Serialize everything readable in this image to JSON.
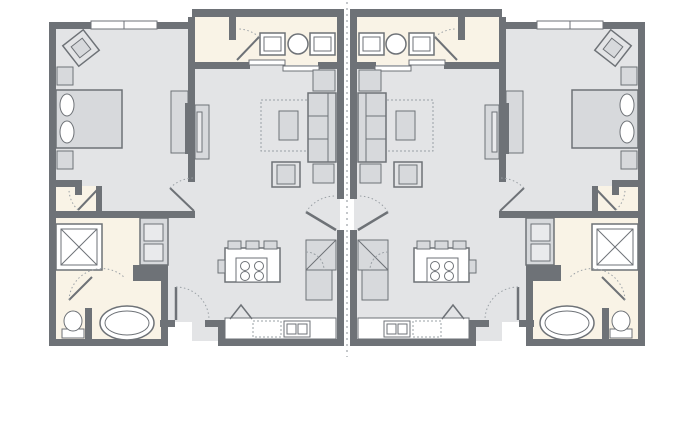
{
  "canvas": {
    "width": 697,
    "height": 445,
    "background": "#ffffff"
  },
  "palette": {
    "wall": "#6e7277",
    "floor_gray": "#e3e4e6",
    "floor_cream": "#f9f3e6",
    "furniture": "#d7d9dc",
    "furniture_light": "#e9eaec",
    "white": "#ffffff",
    "outline": "#6e7277",
    "dots": "#9aa0a5",
    "demising": "#c4c7ca",
    "none": "none"
  },
  "demising_line": {
    "name": "demising-line",
    "x": 347,
    "y1": 2,
    "y2": 357,
    "dash": "2 4",
    "stroke": "demising",
    "sw": 2
  },
  "units": [
    {
      "id": "unit-left",
      "mirrored": false
    },
    {
      "id": "unit-right",
      "mirrored": true,
      "mirror_translate": 694
    }
  ],
  "rooms": [
    "bedroom",
    "closet",
    "vanity-hall",
    "living-room",
    "kitchen",
    "bathroom",
    "laundry",
    "entry"
  ],
  "shapes": [
    {
      "name": "floor-bedroom",
      "type": "rect",
      "x": 56,
      "y": 25,
      "w": 136,
      "h": 190,
      "f": "floor_gray"
    },
    {
      "name": "floor-vanity-hall",
      "type": "rect",
      "x": 192,
      "y": 15,
      "w": 148,
      "h": 50,
      "f": "floor_cream"
    },
    {
      "name": "floor-living-kitchen",
      "type": "rect",
      "x": 192,
      "y": 65,
      "w": 148,
      "h": 276,
      "f": "floor_gray"
    },
    {
      "name": "floor-entry-corridor",
      "type": "rect",
      "x": 160,
      "y": 215,
      "w": 32,
      "h": 107,
      "f": "floor_gray"
    },
    {
      "name": "floor-bathroom",
      "type": "rect",
      "x": 56,
      "y": 215,
      "w": 105,
      "h": 128,
      "f": "floor_cream"
    },
    {
      "name": "floor-closet",
      "type": "rect",
      "x": 56,
      "y": 186,
      "w": 40,
      "h": 27,
      "f": "floor_cream"
    },
    {
      "name": "wall-left-outer",
      "type": "rect",
      "x": 49,
      "y": 22,
      "w": 7,
      "h": 324,
      "f": "wall"
    },
    {
      "name": "wall-bedroom-top",
      "type": "rect",
      "x": 49,
      "y": 22,
      "w": 146,
      "h": 7,
      "f": "wall"
    },
    {
      "name": "window-bedroom-1",
      "type": "rect",
      "x": 91,
      "y": 21,
      "w": 33,
      "h": 8,
      "f": "white",
      "s": "outline",
      "sw": 1
    },
    {
      "name": "window-bedroom-2",
      "type": "rect",
      "x": 124,
      "y": 21,
      "w": 33,
      "h": 8,
      "f": "white",
      "s": "outline",
      "sw": 1
    },
    {
      "name": "wall-vanity-top",
      "type": "rect",
      "x": 192,
      "y": 9,
      "w": 152,
      "h": 8,
      "f": "wall"
    },
    {
      "name": "wall-bedroom-right",
      "type": "rect",
      "x": 188,
      "y": 17,
      "w": 7,
      "h": 165,
      "f": "wall"
    },
    {
      "name": "wall-bedroom-bottom",
      "type": "rect",
      "x": 49,
      "y": 211,
      "w": 146,
      "h": 7,
      "f": "wall"
    },
    {
      "name": "wall-closet-top",
      "type": "rect",
      "x": 49,
      "y": 180,
      "w": 33,
      "h": 7,
      "f": "wall"
    },
    {
      "name": "wall-closet-stub",
      "type": "rect",
      "x": 75,
      "y": 180,
      "w": 7,
      "h": 15,
      "f": "wall"
    },
    {
      "name": "wall-closet-right",
      "type": "rect",
      "x": 96,
      "y": 186,
      "w": 6,
      "h": 26,
      "f": "wall"
    },
    {
      "name": "wall-vanity-bottom-left",
      "type": "rect",
      "x": 192,
      "y": 62,
      "w": 58,
      "h": 7,
      "f": "wall"
    },
    {
      "name": "wall-vanity-bottom-right",
      "type": "rect",
      "x": 318,
      "y": 62,
      "w": 26,
      "h": 7,
      "f": "wall"
    },
    {
      "name": "wall-vanity-partition",
      "type": "rect",
      "x": 229,
      "y": 17,
      "w": 7,
      "h": 23,
      "f": "wall"
    },
    {
      "name": "wall-center-upper",
      "type": "rect",
      "x": 337,
      "y": 9,
      "w": 7,
      "h": 190,
      "f": "wall"
    },
    {
      "name": "wall-center-lower",
      "type": "rect",
      "x": 337,
      "y": 230,
      "w": 7,
      "h": 116,
      "f": "wall"
    },
    {
      "name": "wall-living-bottom-a",
      "type": "rect",
      "x": 160,
      "y": 320,
      "w": 15,
      "h": 7,
      "f": "wall"
    },
    {
      "name": "wall-living-bottom-b",
      "type": "rect",
      "x": 205,
      "y": 320,
      "w": 20,
      "h": 7,
      "f": "wall"
    },
    {
      "name": "wall-kitchen-jog",
      "type": "rect",
      "x": 218,
      "y": 320,
      "w": 7,
      "h": 26,
      "f": "wall"
    },
    {
      "name": "wall-kitchen-bottom",
      "type": "rect",
      "x": 218,
      "y": 339,
      "w": 126,
      "h": 7,
      "f": "wall"
    },
    {
      "name": "wall-bathroom-bottom",
      "type": "rect",
      "x": 49,
      "y": 339,
      "w": 119,
      "h": 7,
      "f": "wall"
    },
    {
      "name": "wall-bathroom-right",
      "type": "rect",
      "x": 161,
      "y": 272,
      "w": 7,
      "h": 74,
      "f": "wall"
    },
    {
      "name": "wall-laundry-bottom",
      "type": "rect",
      "x": 133,
      "y": 265,
      "w": 35,
      "h": 16,
      "f": "wall"
    },
    {
      "name": "wall-toilet-partition",
      "type": "rect",
      "x": 85,
      "y": 308,
      "w": 7,
      "h": 31,
      "f": "wall"
    },
    {
      "name": "sliding-door-panel-1",
      "type": "rect",
      "x": 249,
      "y": 60,
      "w": 36,
      "h": 5,
      "f": "white",
      "s": "outline",
      "sw": 1
    },
    {
      "name": "sliding-door-panel-2",
      "type": "rect",
      "x": 283,
      "y": 66,
      "w": 36,
      "h": 5,
      "f": "white",
      "s": "outline",
      "sw": 1
    },
    {
      "name": "bedroom-chair-outer",
      "type": "rect",
      "x": 68,
      "y": 35,
      "w": 26,
      "h": 26,
      "f": "floor_gray",
      "s": "outline",
      "sw": 1.5,
      "tr": "rotate(-38 81 48)"
    },
    {
      "name": "bedroom-chair-inner",
      "type": "rect",
      "x": 74,
      "y": 41,
      "w": 14,
      "h": 14,
      "f": "furniture",
      "s": "outline",
      "sw": 1,
      "tr": "rotate(-38 81 48)"
    },
    {
      "name": "bedroom-side-table",
      "type": "rect",
      "x": 57,
      "y": 67,
      "w": 16,
      "h": 18,
      "f": "furniture",
      "s": "outline",
      "sw": 1
    },
    {
      "name": "bed",
      "type": "rect",
      "x": 56,
      "y": 90,
      "w": 66,
      "h": 58,
      "f": "furniture",
      "s": "outline",
      "sw": 1.5
    },
    {
      "name": "bed-pillow-1",
      "type": "ellipse",
      "cx": 67,
      "cy": 105,
      "rx": 7,
      "ry": 11,
      "f": "white",
      "s": "outline",
      "sw": 1
    },
    {
      "name": "bed-pillow-2",
      "type": "ellipse",
      "cx": 67,
      "cy": 132,
      "rx": 7,
      "ry": 11,
      "f": "white",
      "s": "outline",
      "sw": 1
    },
    {
      "name": "bedroom-nightstand",
      "type": "rect",
      "x": 57,
      "y": 151,
      "w": 16,
      "h": 18,
      "f": "furniture",
      "s": "outline",
      "sw": 1
    },
    {
      "name": "bedroom-dresser",
      "type": "rect",
      "x": 171,
      "y": 91,
      "w": 17,
      "h": 62,
      "f": "furniture",
      "s": "outline",
      "sw": 1
    },
    {
      "name": "tv-bedroom",
      "type": "rect",
      "x": 185,
      "y": 103,
      "w": 5,
      "h": 51,
      "f": "wall"
    },
    {
      "name": "tv-console-living",
      "type": "rect",
      "x": 195,
      "y": 105,
      "w": 14,
      "h": 54,
      "f": "furniture",
      "s": "outline",
      "sw": 1
    },
    {
      "name": "tv-living",
      "type": "rect",
      "x": 197,
      "y": 112,
      "w": 5,
      "h": 40,
      "f": "furniture_light",
      "s": "outline",
      "sw": 1
    },
    {
      "name": "area-rug",
      "type": "rect",
      "x": 261,
      "y": 100,
      "w": 47,
      "h": 51,
      "f": "none",
      "s": "dots",
      "sw": 1,
      "dash": "2 2"
    },
    {
      "name": "sofa",
      "type": "rect",
      "x": 308,
      "y": 93,
      "w": 28,
      "h": 69,
      "f": "furniture",
      "s": "outline",
      "sw": 1.5
    },
    {
      "name": "sofa-back-line",
      "type": "line",
      "x1": 328,
      "y1": 93,
      "x2": 328,
      "y2": 162,
      "s": "outline",
      "sw": 1
    },
    {
      "name": "sofa-cushion-line-1",
      "type": "line",
      "x1": 308,
      "y1": 116,
      "x2": 328,
      "y2": 116,
      "s": "outline",
      "sw": 1
    },
    {
      "name": "sofa-cushion-line-2",
      "type": "line",
      "x1": 308,
      "y1": 139,
      "x2": 328,
      "y2": 139,
      "s": "outline",
      "sw": 1
    },
    {
      "name": "end-table-top",
      "type": "rect",
      "x": 313,
      "y": 70,
      "w": 22,
      "h": 21,
      "f": "furniture",
      "s": "outline",
      "sw": 1
    },
    {
      "name": "end-table-bottom",
      "type": "rect",
      "x": 313,
      "y": 164,
      "w": 21,
      "h": 19,
      "f": "furniture",
      "s": "outline",
      "sw": 1
    },
    {
      "name": "coffee-table",
      "type": "rect",
      "x": 279,
      "y": 111,
      "w": 19,
      "h": 29,
      "f": "furniture",
      "s": "outline",
      "sw": 1
    },
    {
      "name": "armchair",
      "type": "rect",
      "x": 272,
      "y": 162,
      "w": 28,
      "h": 25,
      "f": "floor_gray",
      "s": "outline",
      "sw": 1.5
    },
    {
      "name": "armchair-cushion",
      "type": "rect",
      "x": 277,
      "y": 165,
      "w": 18,
      "h": 19,
      "f": "furniture",
      "s": "outline",
      "sw": 1
    },
    {
      "name": "kitchen-island",
      "type": "rect",
      "x": 225,
      "y": 248,
      "w": 55,
      "h": 34,
      "f": "white",
      "s": "outline",
      "sw": 1.5
    },
    {
      "name": "bar-stool-1",
      "type": "rect",
      "x": 228,
      "y": 241,
      "w": 13,
      "h": 8,
      "f": "furniture",
      "s": "outline",
      "sw": 1
    },
    {
      "name": "bar-stool-2",
      "type": "rect",
      "x": 246,
      "y": 241,
      "w": 13,
      "h": 8,
      "f": "furniture",
      "s": "outline",
      "sw": 1
    },
    {
      "name": "bar-stool-3",
      "type": "rect",
      "x": 264,
      "y": 241,
      "w": 13,
      "h": 8,
      "f": "furniture",
      "s": "outline",
      "sw": 1
    },
    {
      "name": "island-handle",
      "type": "rect",
      "x": 218,
      "y": 260,
      "w": 7,
      "h": 13,
      "f": "furniture",
      "s": "outline",
      "sw": 1
    },
    {
      "name": "cooktop",
      "type": "rect",
      "x": 236,
      "y": 258,
      "w": 31,
      "h": 24,
      "f": "white",
      "s": "outline",
      "sw": 1
    },
    {
      "name": "burner-1",
      "type": "circle",
      "cx": 245,
      "cy": 266,
      "r": 4.5,
      "f": "white",
      "s": "outline",
      "sw": 1
    },
    {
      "name": "burner-2",
      "type": "circle",
      "cx": 259,
      "cy": 266,
      "r": 4.5,
      "f": "white",
      "s": "outline",
      "sw": 1
    },
    {
      "name": "burner-3",
      "type": "circle",
      "cx": 245,
      "cy": 276,
      "r": 4.5,
      "f": "white",
      "s": "outline",
      "sw": 1
    },
    {
      "name": "burner-4",
      "type": "circle",
      "cx": 259,
      "cy": 276,
      "r": 4.5,
      "f": "white",
      "s": "outline",
      "sw": 1
    },
    {
      "name": "fridge",
      "type": "rect",
      "x": 306,
      "y": 240,
      "w": 30,
      "h": 30,
      "f": "furniture",
      "s": "outline",
      "sw": 1
    },
    {
      "name": "fridge-door-line",
      "type": "line",
      "x1": 306,
      "y1": 270,
      "x2": 336,
      "y2": 240,
      "s": "outline",
      "sw": 1
    },
    {
      "name": "pantry-cabinet",
      "type": "rect",
      "x": 306,
      "y": 270,
      "w": 26,
      "h": 30,
      "f": "furniture",
      "s": "outline",
      "sw": 1
    },
    {
      "name": "cabinet-arc",
      "type": "path",
      "d": "M 306,252 A 18,18 0 0 1 324,270",
      "f": "none",
      "s": "dots",
      "sw": 1,
      "dash": "2 2"
    },
    {
      "name": "kitchen-counter",
      "type": "rect",
      "x": 225,
      "y": 318,
      "w": 111,
      "h": 21,
      "f": "white",
      "s": "outline",
      "sw": 1
    },
    {
      "name": "dishwasher",
      "type": "rect",
      "x": 253,
      "y": 321,
      "w": 28,
      "h": 16,
      "f": "white",
      "s": "dots",
      "sw": 1,
      "dash": "2 2"
    },
    {
      "name": "kitchen-sink",
      "type": "rect",
      "x": 284,
      "y": 321,
      "w": 26,
      "h": 16,
      "f": "white",
      "s": "outline",
      "sw": 1
    },
    {
      "name": "sink-basin-1",
      "type": "rect",
      "x": 287,
      "y": 324,
      "w": 9,
      "h": 10,
      "f": "white",
      "s": "outline",
      "sw": 1
    },
    {
      "name": "sink-basin-2",
      "type": "rect",
      "x": 298,
      "y": 324,
      "w": 9,
      "h": 10,
      "f": "white",
      "s": "outline",
      "sw": 1
    },
    {
      "name": "louver-door-symbol",
      "type": "polyline",
      "pts": "230,319 241,305 252,319",
      "f": "none",
      "s": "outline",
      "sw": 1.5
    },
    {
      "name": "shower",
      "type": "rect",
      "x": 56,
      "y": 224,
      "w": 46,
      "h": 46,
      "f": "white",
      "s": "outline",
      "sw": 1.5
    },
    {
      "name": "shower-inner",
      "type": "rect",
      "x": 61,
      "y": 229,
      "w": 36,
      "h": 36,
      "f": "white",
      "s": "outline",
      "sw": 1
    },
    {
      "name": "shower-x-1",
      "type": "line",
      "x1": 61,
      "y1": 229,
      "x2": 97,
      "y2": 265,
      "s": "outline",
      "sw": 1
    },
    {
      "name": "shower-x-2",
      "type": "line",
      "x1": 97,
      "y1": 229,
      "x2": 61,
      "y2": 265,
      "s": "outline",
      "sw": 1
    },
    {
      "name": "laundry-cabinet",
      "type": "rect",
      "x": 140,
      "y": 218,
      "w": 28,
      "h": 47,
      "f": "furniture",
      "s": "outline",
      "sw": 1.5
    },
    {
      "name": "washer",
      "type": "rect",
      "x": 144,
      "y": 224,
      "w": 19,
      "h": 17,
      "f": "furniture_light",
      "s": "outline",
      "sw": 1
    },
    {
      "name": "dryer",
      "type": "rect",
      "x": 144,
      "y": 244,
      "w": 19,
      "h": 17,
      "f": "furniture_light",
      "s": "outline",
      "sw": 1
    },
    {
      "name": "toilet-tank",
      "type": "rect",
      "x": 62,
      "y": 329,
      "w": 22,
      "h": 9,
      "f": "white",
      "s": "outline",
      "sw": 1
    },
    {
      "name": "toilet-bowl",
      "type": "ellipse",
      "cx": 73,
      "cy": 321,
      "rx": 9,
      "ry": 10,
      "f": "white",
      "s": "outline",
      "sw": 1
    },
    {
      "name": "bathtub",
      "type": "ellipse",
      "cx": 127,
      "cy": 323,
      "rx": 27,
      "ry": 17,
      "f": "white",
      "s": "outline",
      "sw": 1.5
    },
    {
      "name": "bathtub-inner",
      "type": "ellipse",
      "cx": 127,
      "cy": 323,
      "rx": 22,
      "ry": 12,
      "f": "none",
      "s": "outline",
      "sw": 1
    },
    {
      "name": "vanity-sink-left",
      "type": "rect",
      "x": 260,
      "y": 33,
      "w": 25,
      "h": 22,
      "f": "white",
      "s": "outline",
      "sw": 1.5
    },
    {
      "name": "vanity-sink-left-basin",
      "type": "rect",
      "x": 264,
      "y": 37,
      "w": 17,
      "h": 14,
      "f": "white",
      "s": "outline",
      "sw": 1
    },
    {
      "name": "vanity-round-basin",
      "type": "circle",
      "cx": 298,
      "cy": 44,
      "r": 10,
      "f": "white",
      "s": "outline",
      "sw": 1.5
    },
    {
      "name": "vanity-sink-right",
      "type": "rect",
      "x": 310,
      "y": 33,
      "w": 25,
      "h": 22,
      "f": "white",
      "s": "outline",
      "sw": 1.5
    },
    {
      "name": "vanity-sink-right-basin",
      "type": "rect",
      "x": 314,
      "y": 37,
      "w": 17,
      "h": 14,
      "f": "white",
      "s": "outline",
      "sw": 1
    },
    {
      "name": "door-bedroom",
      "type": "line",
      "x1": 170,
      "y1": 188,
      "x2": 194,
      "y2": 211,
      "s": "outline",
      "sw": 2
    },
    {
      "name": "door-bedroom-arc",
      "type": "path",
      "d": "M 170,188 A 34,34 0 0 1 194,178",
      "f": "none",
      "s": "dots",
      "sw": 1,
      "dash": "1.5 2.5"
    },
    {
      "name": "door-closet",
      "type": "line",
      "x1": 98,
      "y1": 189,
      "x2": 78,
      "y2": 210,
      "s": "outline",
      "sw": 2
    },
    {
      "name": "door-closet-arc",
      "type": "path",
      "d": "M 78,210 A 29,29 0 0 1 69,190",
      "f": "none",
      "s": "dots",
      "sw": 1,
      "dash": "1.5 2.5"
    },
    {
      "name": "door-vanity-closet",
      "type": "line",
      "x1": 237,
      "y1": 60,
      "x2": 259,
      "y2": 37,
      "s": "outline",
      "sw": 2
    },
    {
      "name": "door-vanity-closet-arc",
      "type": "path",
      "d": "M 259,37 A 32,32 0 0 0 237,29",
      "f": "none",
      "s": "dots",
      "sw": 1,
      "dash": "1.5 2.5"
    },
    {
      "name": "door-connecting",
      "type": "line",
      "x1": 306,
      "y1": 212,
      "x2": 336,
      "y2": 230,
      "s": "outline",
      "sw": 2.5
    },
    {
      "name": "door-connecting-arc",
      "type": "path",
      "d": "M 306,212 A 35,35 0 0 1 336,196",
      "f": "none",
      "s": "dots",
      "sw": 1,
      "dash": "1.5 2.5"
    },
    {
      "name": "door-entry",
      "type": "line",
      "x1": 176,
      "y1": 287,
      "x2": 176,
      "y2": 320,
      "s": "outline",
      "sw": 2.5
    },
    {
      "name": "door-entry-arc",
      "type": "path",
      "d": "M 176,287 A 33,33 0 0 1 209,320",
      "f": "none",
      "s": "dots",
      "sw": 1,
      "dash": "1.5 2.5"
    },
    {
      "name": "door-bathroom",
      "type": "line",
      "x1": 92,
      "y1": 277,
      "x2": 69,
      "y2": 300,
      "s": "outline",
      "sw": 2
    },
    {
      "name": "door-bathroom-arc",
      "type": "path",
      "d": "M 69,300 A 33,33 0 0 1 125,278",
      "f": "none",
      "s": "dots",
      "sw": 1,
      "dash": "1.5 2.5"
    }
  ]
}
